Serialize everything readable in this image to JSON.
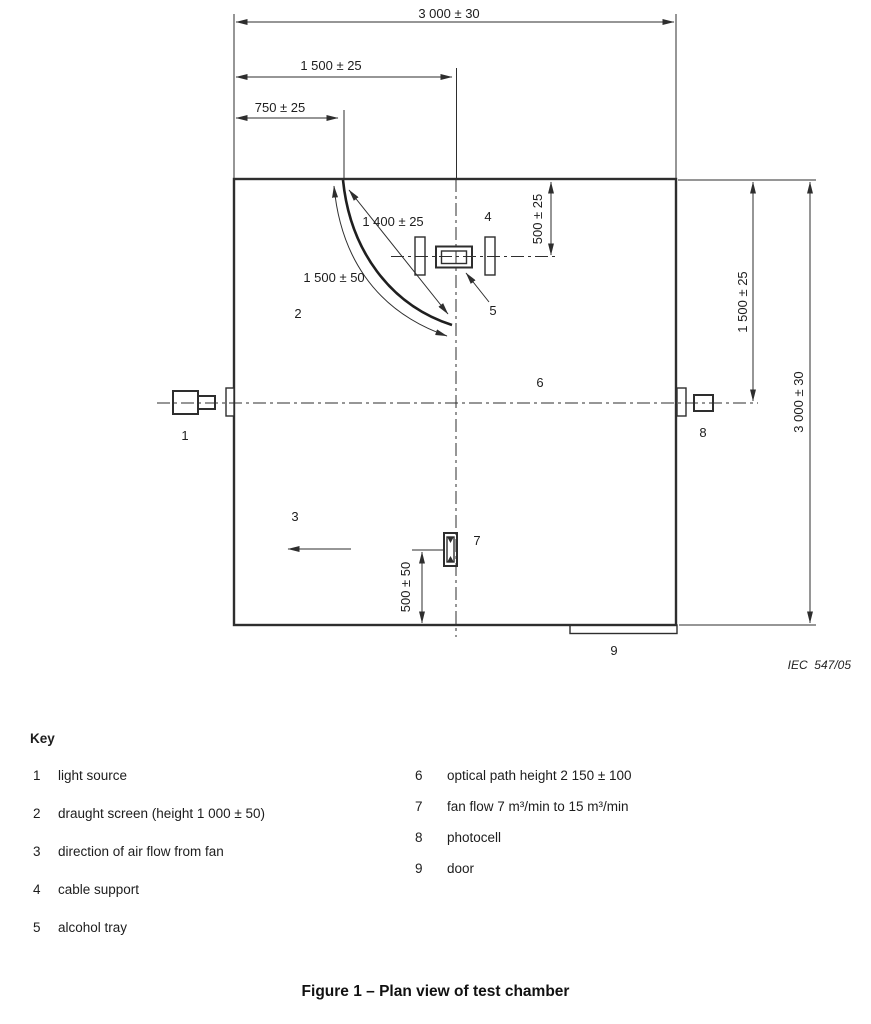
{
  "diagram": {
    "credit": "IEC  547/05",
    "dims": {
      "width_total": "3 000 ± 30",
      "width_half": "1 500 ± 25",
      "width_quarter": "750 ± 25",
      "screen_chord": "1 400 ± 25",
      "screen_length": "1 500 ± 50",
      "cable_support_offset": "500 ± 25",
      "height_half": "1 500 ± 25",
      "height_total": "3 000 ± 30",
      "fan_offset": "500 ± 50"
    },
    "parts": [
      "1",
      "2",
      "3",
      "4",
      "5",
      "6",
      "7",
      "8",
      "9"
    ]
  },
  "key": {
    "title": "Key",
    "left": [
      {
        "num": "1",
        "label": "light source"
      },
      {
        "num": "2",
        "label": "draught screen (height 1 000 ± 50)"
      },
      {
        "num": "3",
        "label": "direction of air flow from fan"
      },
      {
        "num": "4",
        "label": "cable support"
      },
      {
        "num": "5",
        "label": "alcohol tray"
      }
    ],
    "right": [
      {
        "num": "6",
        "label": "optical path height 2 150 ± 100"
      },
      {
        "num": "7",
        "label": "fan flow 7 m³/min to 15 m³/min"
      },
      {
        "num": "8",
        "label": "photocell"
      },
      {
        "num": "9",
        "label": "door"
      }
    ]
  },
  "caption": "Figure 1 – Plan view of test chamber"
}
